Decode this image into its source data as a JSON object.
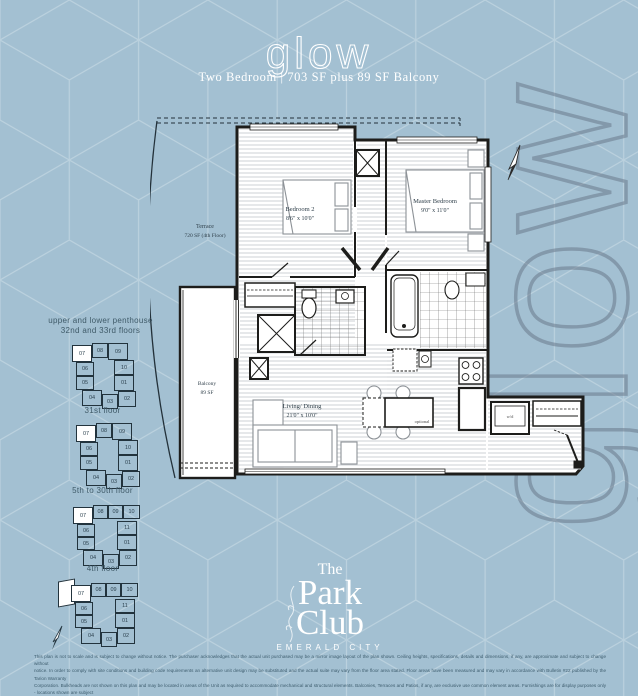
{
  "header": {
    "title": "glow",
    "subtitle": "Two Bedroom | 703 SF plus 89 SF Balcony"
  },
  "watermark": {
    "text": "glow"
  },
  "colors": {
    "background": "#a3c0d2",
    "pattern_line": "#c3d7e2",
    "watermark": "#69788a",
    "wall_ink": "#1d1d1b",
    "label_ink": "#2e3e49",
    "caption_ink": "#3f5a68",
    "highlight_unit": "#ffffff"
  },
  "plan": {
    "terrace": {
      "name": "Terrace",
      "detail": "720 SF (4th Floor)"
    },
    "balcony": {
      "name": "Balcony",
      "area": "89 SF"
    },
    "bedroom2": {
      "name": "Bedroom 2",
      "dims": "8'6\" x 10'0\""
    },
    "master": {
      "name": "Master Bedroom",
      "dims": "9'0\" x 11'0\""
    },
    "living": {
      "name": "Living/ Dining",
      "dims": "21'0\" x 10'0\""
    },
    "optional_label": "optional",
    "washer_dryer_label": "w/d"
  },
  "keyplans": [
    {
      "caption_line1": "upper and lower penthouse",
      "caption_line2": "32nd and 33rd floors",
      "layout": "A",
      "terrace_wing": false,
      "highlight": "07",
      "units": [
        "07",
        "08",
        "09",
        "06",
        "10",
        "05",
        "01",
        "04",
        "03",
        "02"
      ]
    },
    {
      "caption_line1": "31st floor",
      "caption_line2": "",
      "layout": "A",
      "terrace_wing": false,
      "highlight": "07",
      "units": [
        "07",
        "08",
        "09",
        "06",
        "10",
        "05",
        "01",
        "04",
        "03",
        "02"
      ]
    },
    {
      "caption_line1": "5th to 30th floor",
      "caption_line2": "",
      "layout": "B",
      "terrace_wing": false,
      "highlight": "07",
      "units": [
        "07",
        "08",
        "09",
        "10",
        "06",
        "11",
        "05",
        "01",
        "04",
        "03",
        "02"
      ]
    },
    {
      "caption_line1": "4th floor",
      "caption_line2": "",
      "layout": "B",
      "terrace_wing": true,
      "highlight": "07",
      "units": [
        "07",
        "08",
        "09",
        "10",
        "06",
        "11",
        "05",
        "01",
        "04",
        "03",
        "02"
      ]
    }
  ],
  "logo": {
    "the": "The",
    "park": "Park",
    "club": "Club",
    "tagline": "EMERALD CITY"
  },
  "disclaimer": {
    "lines": [
      "This plan is not to scale and is subject to change without notice. The purchaser acknowledges that the actual unit purchased may be a mirror image layout of the plan shown. Ceiling heights, specifications, details and dimensions, if any, are approximate and subject to change without",
      "notice. In order to comply with site conditions and building code requirements an alternative unit design may be substituted and the actual suite may vary from the floor area stated. Floor areas have been measured and may vary in accordance with Bulletin #22 published by the Tarion Warranty",
      "Corporation. Bulkheads are not shown on this plan and may be located in areas of the Unit as required to accommodate mechanical and structural elements. Balconies, Terraces and Patios, if any, are exclusive use common element areas. Furnishings are for display purposes only - locations shown are subject",
      "to change without notice. Window location, size and type may vary without notice. The length, width, material and dimensional position or portion of the flooring or surface covering are for illustrative purposes only and may vary without notice. E. & O.E."
    ]
  }
}
